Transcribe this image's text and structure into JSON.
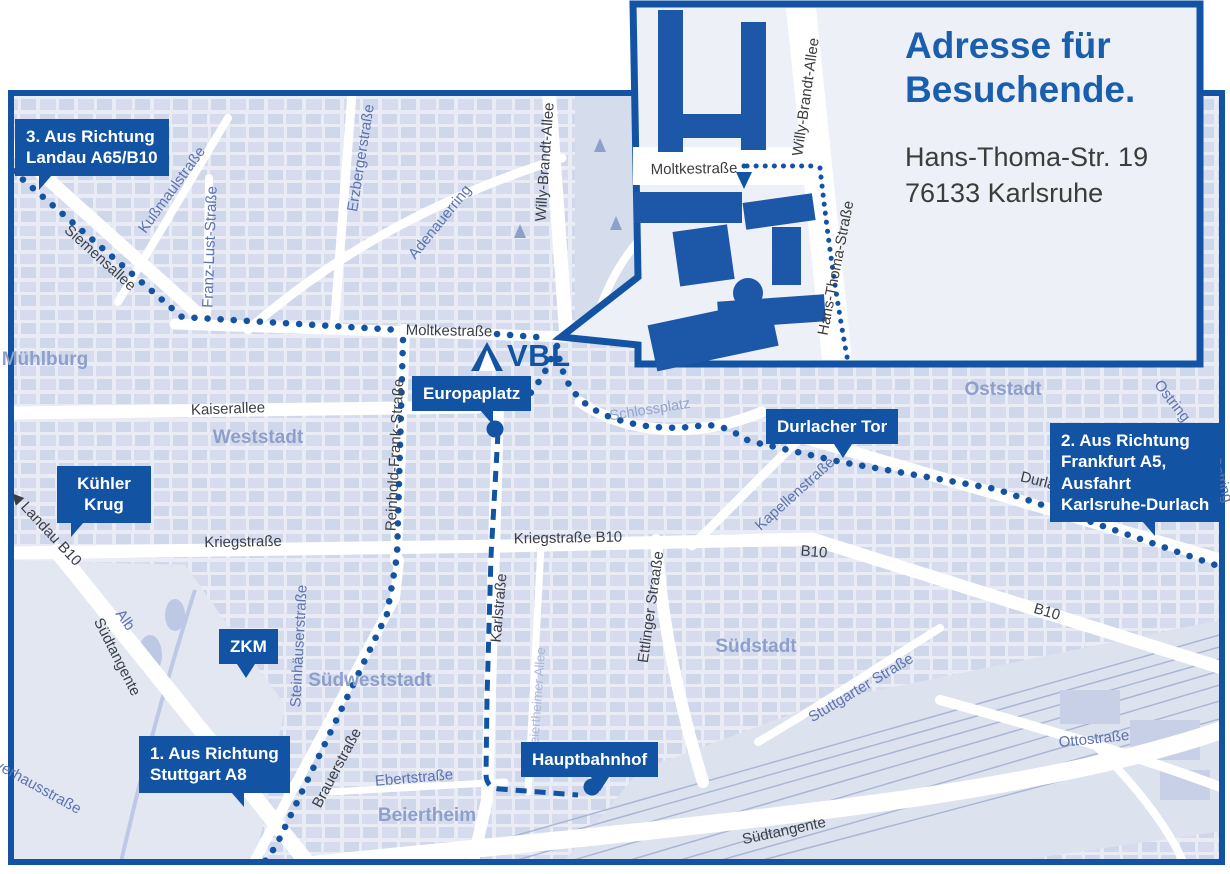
{
  "colors": {
    "accent": "#1254a3",
    "building": "#1d57a8",
    "title_blue": "#1a5fae",
    "map_bg": "#e9ecf5",
    "blocks": "#cfd7ea",
    "area_label": "#8d9fca",
    "street_blue": "#5d72b0",
    "street_dark": "#3a3f47",
    "railway": "#9aa9cc"
  },
  "logo": {
    "text": "VBL",
    "icon": "triangle-logo"
  },
  "inset": {
    "title_line1": "Adresse für",
    "title_line2": "Besuchende.",
    "address_line1": "Hans-Thoma-Str. 19",
    "address_line2": "76133 Karlsruhe",
    "labels": [
      {
        "name": "lbl-inset-moltkestrasse",
        "text": "Moltkestraße",
        "x": 694,
        "y": 169,
        "rot": -1,
        "cls": "inset-lbl"
      },
      {
        "name": "lbl-inset-willy-brandt-allee",
        "text": "Willy-Brandt-Allee",
        "x": 806,
        "y": 97,
        "rot": -82,
        "cls": "inset-lbl"
      },
      {
        "name": "lbl-inset-hans-thoma-strasse",
        "text": "Hans-Thoma-Straße",
        "x": 836,
        "y": 268,
        "rot": -79,
        "cls": "inset-lbl"
      }
    ]
  },
  "badges": [
    {
      "name": "badge-route-3",
      "lines": [
        "3. Aus Richtung",
        "Landau A65/B10"
      ],
      "x": 15,
      "y": 119,
      "tail": {
        "type": "dl",
        "left": 24
      }
    },
    {
      "name": "badge-kuehler-krug",
      "lines": [
        "Kühler",
        "Krug"
      ],
      "x": 57,
      "y": 466,
      "w": 72,
      "center": true,
      "tail": {
        "type": "dl",
        "left": 14
      }
    },
    {
      "name": "badge-zkm",
      "lines": [
        "ZKM"
      ],
      "x": 219,
      "y": 629,
      "tail": {
        "type": "mid",
        "left": 18
      }
    },
    {
      "name": "badge-europaplatz",
      "lines": [
        "Europaplatz"
      ],
      "x": 412,
      "y": 376,
      "tail": {
        "type": "dr",
        "left": 68
      }
    },
    {
      "name": "badge-durlacher-tor",
      "lines": [
        "Durlacher Tor"
      ],
      "x": 766,
      "y": 409,
      "tail": {
        "type": "mid",
        "left": 68
      }
    },
    {
      "name": "badge-route-2",
      "lines": [
        "2. Aus Richtung",
        "Frankfurt A5,",
        "Ausfahrt",
        "Karlsruhe-Durlach"
      ],
      "x": 1050,
      "y": 423,
      "tail": {
        "type": "dr",
        "left": 92
      }
    },
    {
      "name": "badge-hauptbahnhof",
      "lines": [
        "Hauptbahnhof"
      ],
      "x": 521,
      "y": 742,
      "tail": {
        "type": "mid",
        "left": 70
      }
    },
    {
      "name": "badge-route-1",
      "lines": [
        "1. Aus Richtung",
        "Stuttgart A8"
      ],
      "x": 139,
      "y": 736,
      "tail": {
        "type": "dr",
        "left": 92
      }
    }
  ],
  "street_labels": [
    {
      "name": "lbl-siemensallee",
      "text": "Siemensallee",
      "x": 100,
      "y": 258,
      "rot": 42,
      "cls": "st-dark"
    },
    {
      "name": "lbl-moltkestrasse",
      "text": "Moltkestraße",
      "x": 449,
      "y": 331,
      "rot": 1,
      "cls": "st-dark"
    },
    {
      "name": "lbl-willy-brandt-allee",
      "text": "Willy-Brandt-Allee",
      "x": 545,
      "y": 162,
      "rot": -86,
      "cls": "st-dark"
    },
    {
      "name": "lbl-kaiserallee",
      "text": "Kaiserallee",
      "x": 228,
      "y": 409,
      "rot": -2,
      "cls": "st-dark"
    },
    {
      "name": "lbl-kriegstrasse",
      "text": "Kriegstraße",
      "x": 243,
      "y": 542,
      "rot": -1,
      "cls": "st-dark"
    },
    {
      "name": "lbl-kriegstrasse-b10",
      "text": "Kriegstraße B10",
      "x": 568,
      "y": 538,
      "rot": -1,
      "cls": "st-dark"
    },
    {
      "name": "lbl-b10-mid",
      "text": "B10",
      "x": 814,
      "y": 552,
      "rot": 5,
      "cls": "st-dark"
    },
    {
      "name": "lbl-b10-right",
      "text": "B10",
      "x": 1047,
      "y": 612,
      "rot": 16,
      "cls": "st-dark"
    },
    {
      "name": "lbl-landau-b10",
      "text": "◀ Landau B10",
      "x": 46,
      "y": 528,
      "rot": 47,
      "cls": "st-dark"
    },
    {
      "name": "lbl-reinhold-frank-strasse",
      "text": "Reinhold-Frank-Straße",
      "x": 395,
      "y": 455,
      "rot": -87,
      "cls": "st-dark"
    },
    {
      "name": "lbl-karlstrasse",
      "text": "Karlstraße",
      "x": 499,
      "y": 608,
      "rot": -85,
      "cls": "st-dark"
    },
    {
      "name": "lbl-ettlinger-strasse",
      "text": "Ettlinger Straaße",
      "x": 651,
      "y": 607,
      "rot": -82,
      "cls": "st-dark"
    },
    {
      "name": "lbl-suedtangente-left",
      "text": "Südtangente",
      "x": 117,
      "y": 657,
      "rot": 63,
      "cls": "st-dark"
    },
    {
      "name": "lbl-suedtangente-bottom",
      "text": "Südtangente",
      "x": 784,
      "y": 831,
      "rot": -12,
      "cls": "st-dark"
    },
    {
      "name": "lbl-brauerstrasse",
      "text": "Brauerstraße",
      "x": 337,
      "y": 768,
      "rot": -62,
      "cls": "st-dark"
    },
    {
      "name": "lbl-durlacher-allee",
      "text": "Durlacher Allee",
      "x": 1070,
      "y": 489,
      "rot": 14,
      "cls": "st-dark"
    },
    {
      "name": "lbl-kussmaulstrasse",
      "text": "Kußmaulstraße",
      "x": 172,
      "y": 190,
      "rot": -54,
      "cls": "st-blue"
    },
    {
      "name": "lbl-franz-lust-strasse",
      "text": "Franz-Lust-Straße",
      "x": 210,
      "y": 247,
      "rot": -88,
      "cls": "st-blue"
    },
    {
      "name": "lbl-erzbergerstrasse",
      "text": "Erzbergerstraße",
      "x": 361,
      "y": 158,
      "rot": -81,
      "cls": "st-blue"
    },
    {
      "name": "lbl-adenauerring",
      "text": "Adenauerring",
      "x": 440,
      "y": 222,
      "rot": -51,
      "cls": "st-blue"
    },
    {
      "name": "lbl-kapellenstrasse",
      "text": "Kapellenstraße",
      "x": 795,
      "y": 494,
      "rot": -42,
      "cls": "st-blue"
    },
    {
      "name": "lbl-ebertstrasse",
      "text": "Ebertstraße",
      "x": 414,
      "y": 778,
      "rot": -5,
      "cls": "st-blue"
    },
    {
      "name": "lbl-ottostrasse",
      "text": "Ottostraße",
      "x": 1094,
      "y": 739,
      "rot": -6,
      "cls": "st-blue"
    },
    {
      "name": "lbl-stuttgarter-strasse",
      "text": "Stuttgarter Straße",
      "x": 861,
      "y": 688,
      "rot": -31,
      "cls": "st-blue"
    },
    {
      "name": "lbl-steinhaeuserstrasse",
      "text": "Steinhäuserstraße",
      "x": 299,
      "y": 646,
      "rot": -87,
      "cls": "st-blue"
    },
    {
      "name": "lbl-alb",
      "text": "Alb",
      "x": 125,
      "y": 620,
      "rot": 55,
      "cls": "st-blue"
    },
    {
      "name": "lbl-verhausstrasse",
      "text": "verhausstraße",
      "x": 38,
      "y": 787,
      "rot": 29,
      "cls": "st-blue"
    },
    {
      "name": "lbl-ostring-1",
      "text": "Ostring",
      "x": 1172,
      "y": 401,
      "rot": 52,
      "cls": "st-blue"
    },
    {
      "name": "lbl-ostring-2",
      "text": "Ostring",
      "x": 1221,
      "y": 479,
      "rot": 72,
      "cls": "st-blue"
    },
    {
      "name": "lbl-schlossplatz",
      "text": "Schlossplatz",
      "x": 650,
      "y": 410,
      "rot": -9,
      "cls": "area-sm"
    },
    {
      "name": "lbl-beiertheimer-allee",
      "text": "Beiertheimer Allee",
      "x": 537,
      "y": 700,
      "rot": -86,
      "cls": "st-light"
    }
  ],
  "area_labels": [
    {
      "name": "lbl-muehlburg",
      "text": "Mühlburg",
      "x": 45,
      "y": 360
    },
    {
      "name": "lbl-weststadt",
      "text": "Weststadt",
      "x": 258,
      "y": 438
    },
    {
      "name": "lbl-oststadt",
      "text": "Oststadt",
      "x": 1003,
      "y": 390
    },
    {
      "name": "lbl-suedstadt",
      "text": "Südstadt",
      "x": 756,
      "y": 647
    },
    {
      "name": "lbl-suedweststadt",
      "text": "Südweststadt",
      "x": 370,
      "y": 681
    },
    {
      "name": "lbl-beiertheim",
      "text": "Beiertheim",
      "x": 427,
      "y": 816
    }
  ]
}
